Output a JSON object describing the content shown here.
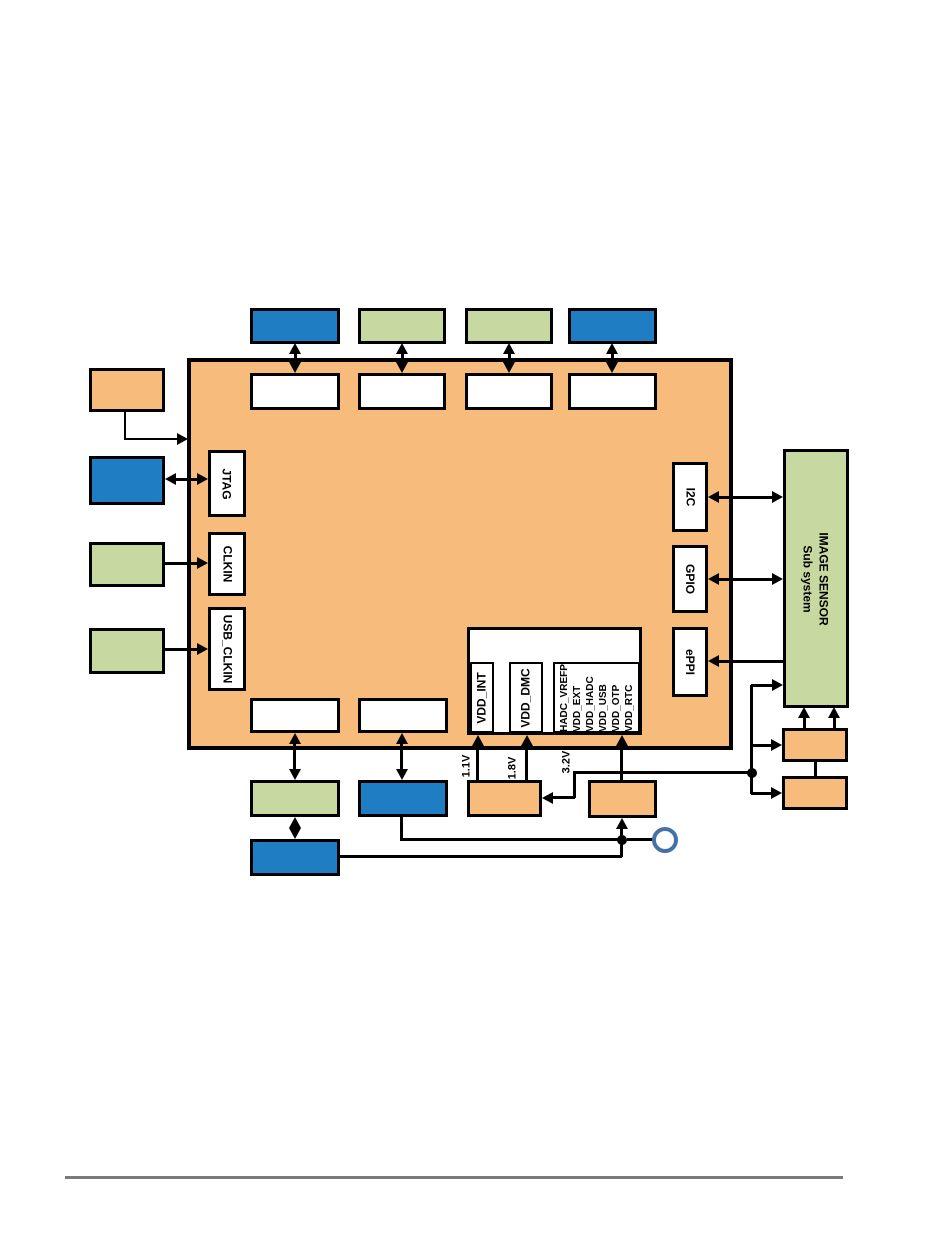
{
  "colors": {
    "orange": "#F7BB7C",
    "blue": "#1F7EC3",
    "green": "#C7D8A1",
    "line": "#000000",
    "circle_stroke": "#4571A8",
    "rule": "#7A7A7A"
  },
  "soc": {
    "ports_left": [
      {
        "label": "JTAG"
      },
      {
        "label": "CLKIN"
      },
      {
        "label": "USB_CLKIN"
      }
    ],
    "ports_right": [
      {
        "label": "I2C"
      },
      {
        "label": "GPIO"
      },
      {
        "label": "ePPI"
      }
    ],
    "power": {
      "rails": [
        "VDD_INT",
        "VDD_DMC"
      ],
      "rail_group": [
        "HADC_VREFP",
        "VDD_EXT",
        "VDD_HADC",
        "VDD_USB",
        "VDD_OTP",
        "VDD_RTC"
      ]
    }
  },
  "voltages": [
    "1.1V",
    "1.8V",
    "3.2V"
  ],
  "image_sensor": {
    "line1": "IMAGE SENSOR",
    "line2": "Sub system"
  }
}
